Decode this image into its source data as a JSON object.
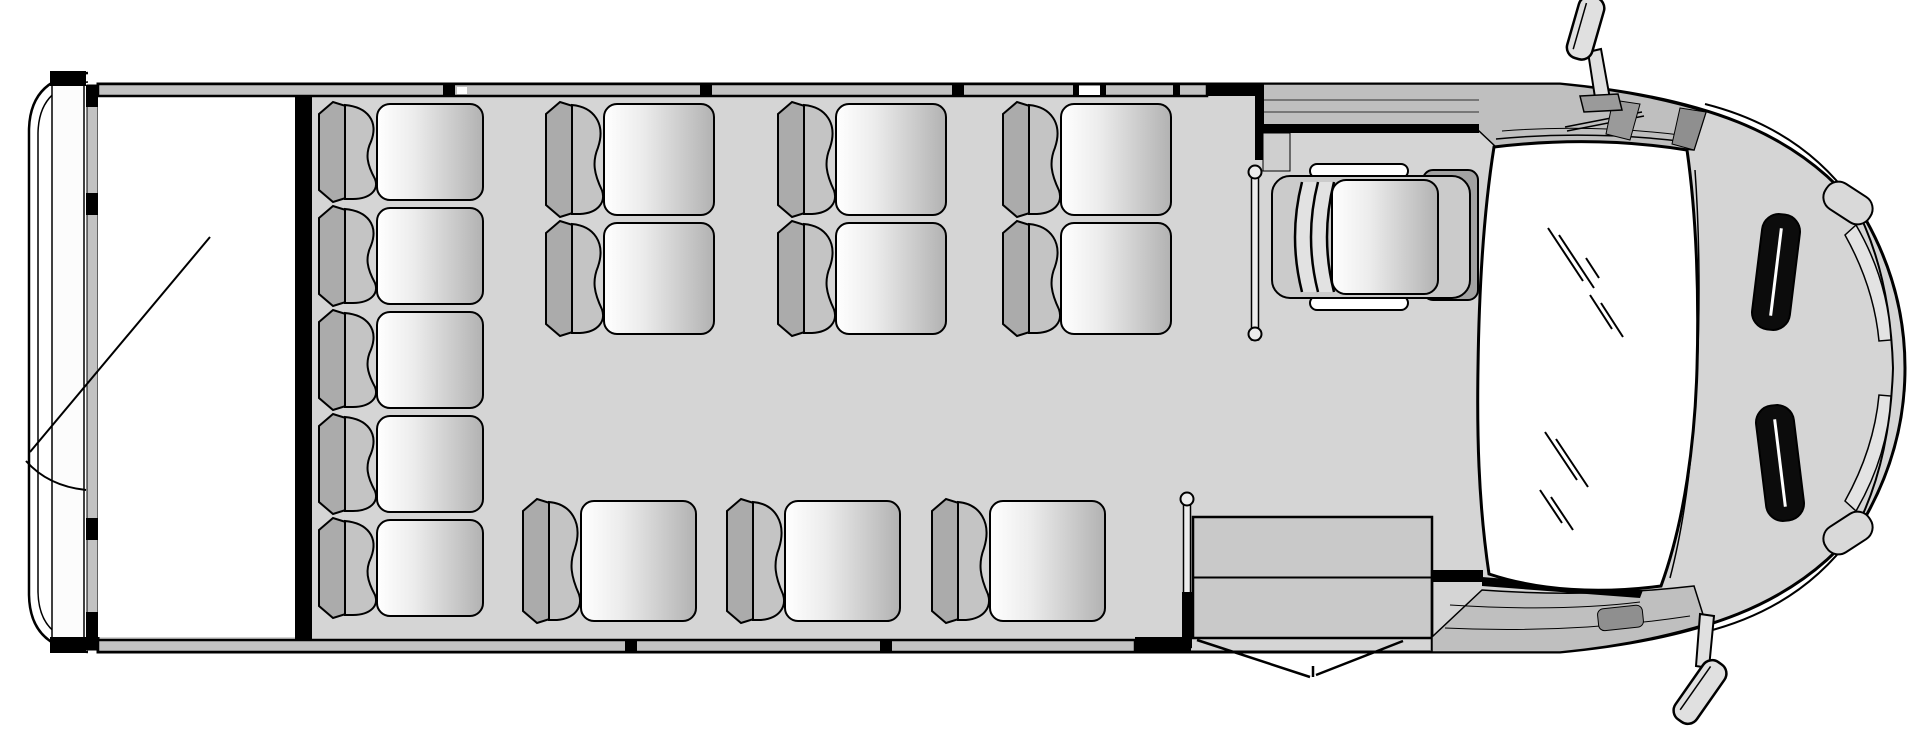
{
  "diagram": {
    "type": "vehicle-floor-plan",
    "vehicle": "shuttle-bus",
    "view": "top-down",
    "front_direction": "right",
    "passenger_capacity": 14,
    "total_seats": 15
  },
  "colors": {
    "outline": "#000000",
    "floor": "#d5d5d5",
    "wall_band": "#c2c2c2",
    "white_area": "#ffffff",
    "seat_band": "#ababab",
    "seat_back": "#c4c4c4",
    "cushion_light": "#ffffff",
    "cushion_dark": "#b2b2b2",
    "glass": "#ffffff",
    "vent": "#0c0c0c",
    "step": "#c9c9c9",
    "cab_trim": "#bfbfbf",
    "dash_panel": "#a2a2a2",
    "mirror": "#e0e0e0"
  },
  "seating": {
    "units": [
      {
        "id": "rear-bench",
        "type": "bench",
        "seats": 5,
        "facing": "forward",
        "x": 315,
        "y": 100,
        "w": 172,
        "h": 520
      },
      {
        "id": "mid-double-1",
        "type": "double",
        "seats": 2,
        "facing": "forward",
        "x": 542,
        "y": 100,
        "w": 176,
        "h": 238
      },
      {
        "id": "mid-double-2",
        "type": "double",
        "seats": 2,
        "facing": "forward",
        "x": 774,
        "y": 100,
        "w": 176,
        "h": 238
      },
      {
        "id": "mid-double-3",
        "type": "double",
        "seats": 2,
        "facing": "forward",
        "x": 999,
        "y": 100,
        "w": 176,
        "h": 238
      },
      {
        "id": "aisle-single-1",
        "type": "single",
        "seats": 1,
        "facing": "forward",
        "x": 519,
        "y": 497,
        "w": 181,
        "h": 128
      },
      {
        "id": "aisle-single-2",
        "type": "single",
        "seats": 1,
        "facing": "forward",
        "x": 723,
        "y": 497,
        "w": 181,
        "h": 128
      },
      {
        "id": "aisle-single-3",
        "type": "single",
        "seats": 1,
        "facing": "forward",
        "x": 928,
        "y": 497,
        "w": 181,
        "h": 128
      },
      {
        "id": "driver-seat",
        "type": "driver",
        "seats": 1,
        "facing": "forward",
        "x": 1272,
        "y": 164,
        "w": 198,
        "h": 146
      }
    ]
  },
  "entry_door": {
    "position": "front-right",
    "state": "open",
    "steps": {
      "x": 1193,
      "y": 517,
      "width": 239,
      "height": 121,
      "treads": 2
    }
  },
  "rear_door": {
    "position": "rear",
    "state": "open",
    "compartment": {
      "x": 98,
      "y": 96,
      "width": 197,
      "height": 541
    }
  },
  "stanchions": [
    {
      "id": "entry-grab-rail",
      "x": 1187,
      "top": 494,
      "bottom": 648,
      "black_from": 592,
      "circle_top": true,
      "circle_bottom": false
    },
    {
      "id": "driver-partition-rail",
      "x": 1255,
      "top": 167,
      "bottom": 340,
      "black_from": null,
      "circle_top": true,
      "circle_bottom": true
    }
  ]
}
